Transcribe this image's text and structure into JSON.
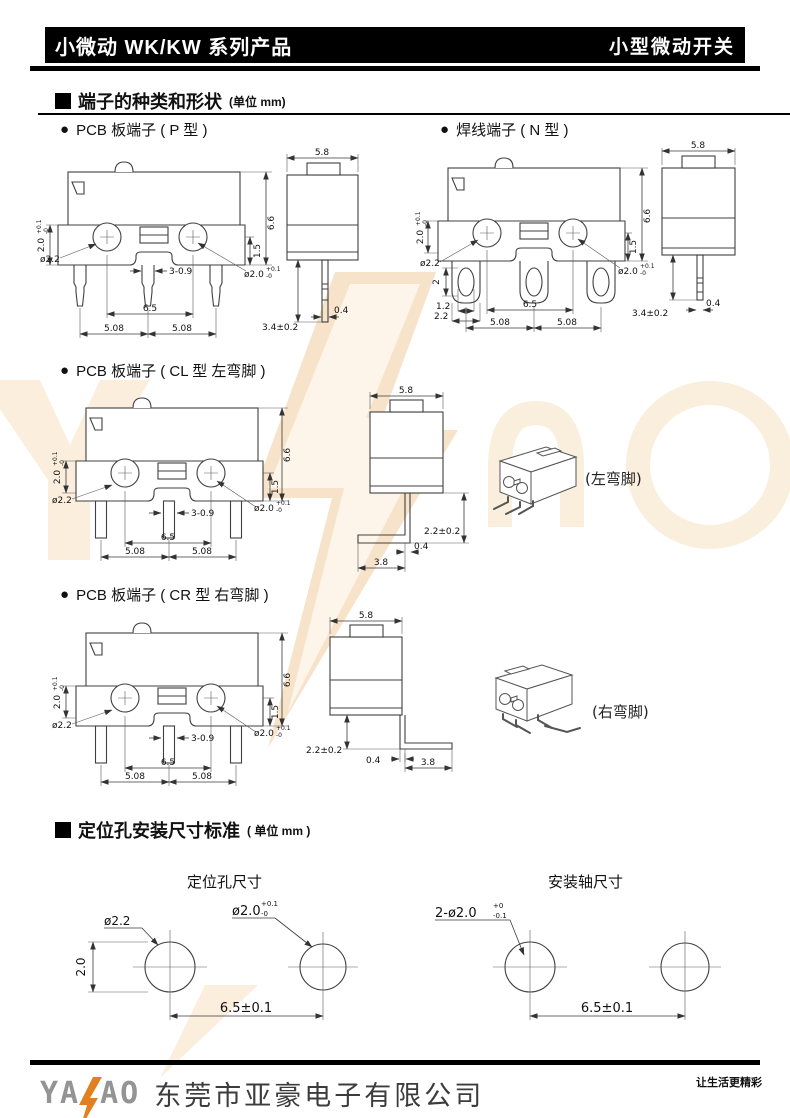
{
  "header": {
    "left": "小微动 WK/KW 系列产品",
    "right": "小型微动开关"
  },
  "sec1": {
    "title": "端子的种类和形状",
    "unit": "(单位 mm)"
  },
  "p": {
    "label": "PCB 板端子 ( P 型 )",
    "h": "6.6",
    "e": "1.5",
    "hv": "2.0",
    "hvt": "+0.1",
    "hvb": "-0",
    "d22": "ø2.2",
    "slot": "3-0.9",
    "d20": "ø2.0",
    "d20t": "+0.1",
    "d20b": "-0",
    "p65": "6.5",
    "p508a": "5.08",
    "p508b": "5.08",
    "w": "5.8",
    "pl": "3.4±0.2",
    "pw": "0.4"
  },
  "n": {
    "label": "焊线端子 ( N 型 )",
    "h": "6.6",
    "e": "1.5",
    "hv": "2.0",
    "hvt": "+0.1",
    "hvb": "-0",
    "d22": "ø2.2",
    "d20": "ø2.0",
    "d20t": "+0.1",
    "d20b": "-0",
    "eh": "2",
    "ew": "1.2",
    "tw": "2.2",
    "p65": "6.5",
    "p508a": "5.08",
    "p508b": "5.08",
    "w": "5.8",
    "pl": "3.4±0.2",
    "pw": "0.4"
  },
  "cl": {
    "label": "PCB 板端子 ( CL 型 左弯脚 )",
    "note": "(左弯脚)",
    "h": "6.6",
    "e": "1.5",
    "hv": "2.0",
    "hvt": "+0.1",
    "hvb": "-0",
    "d22": "ø2.2",
    "slot": "3-0.9",
    "d20": "ø2.0",
    "d20t": "+0.1",
    "d20b": "-0",
    "p65": "6.5",
    "p508a": "5.08",
    "p508b": "5.08",
    "w": "5.8",
    "bend": "3.8",
    "pw": "0.4",
    "drop": "2.2±0.2"
  },
  "cr": {
    "label": "PCB 板端子 ( CR 型 右弯脚 )",
    "note": "(右弯脚)",
    "h": "6.6",
    "e": "1.5",
    "hv": "2.0",
    "hvt": "+0.1",
    "hvb": "-0",
    "d22": "ø2.2",
    "slot": "3-0.9",
    "d20": "ø2.0",
    "d20t": "+0.1",
    "d20b": "-0",
    "p65": "6.5",
    "p508a": "5.08",
    "p508b": "5.08",
    "w": "5.8",
    "bend": "3.8",
    "pw": "0.4",
    "drop": "2.2±0.2"
  },
  "sec2": {
    "title": "定位孔安装尺寸标准",
    "unit": "( 单位 mm )"
  },
  "hole": {
    "title": "定位孔尺寸",
    "dia1": "ø2.2",
    "dia2": "ø2.0",
    "dia2t": "+0.1",
    "dia2b": "-0",
    "v": "2.0",
    "pitch": "6.5±0.1"
  },
  "shaft": {
    "title": "安装轴尺寸",
    "dia": "2-ø2.0",
    "diat": "+0",
    "diab": "-0.1",
    "pitch": "6.5±0.1"
  },
  "footer": {
    "logo1": "YA",
    "logo2": "AO",
    "company": "东莞市亚豪电子有限公司",
    "slogan": "让生活更精彩"
  },
  "colors": {
    "accent_orange": "#e2801f",
    "watermark": "#f8e5cc"
  }
}
